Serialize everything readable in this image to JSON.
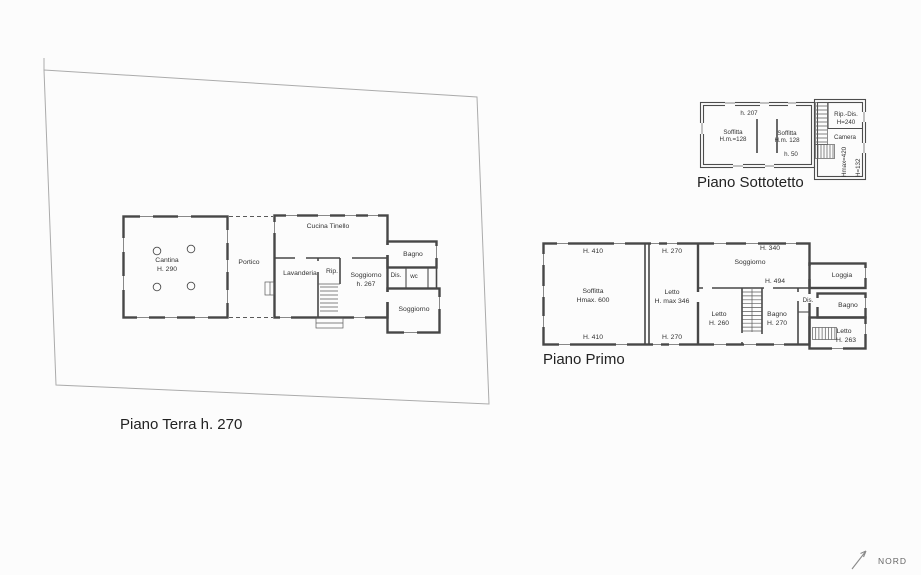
{
  "colors": {
    "background": "#fcfcfc",
    "walls": "#474747",
    "site_boundary": "#ababab",
    "text": "#333333"
  },
  "piano_terra": {
    "title": "Piano Terra h. 270",
    "labels": {
      "cantina": "Cantina",
      "cantina_height": "H. 290",
      "portico": "Portico",
      "cucina_tinello": "Cucina Tinello",
      "lavanderia": "Lavanderia",
      "rip": "Rip.",
      "soggiorno": "Soggiorno",
      "soggiorno_height": "h. 267",
      "dis": "Dis.",
      "wc": "wc",
      "bagno": "Bagno",
      "soggiorno_2": "Soggiorno"
    }
  },
  "piano_primo": {
    "title": "Piano Primo",
    "labels": {
      "h410_top": "H. 410",
      "h410_bottom": "H. 410",
      "soffitta": "Soffitta",
      "soffitta_height": "Hmax. 600",
      "h270_top": "H. 270",
      "h270_bottom": "H. 270",
      "letto_1": "Letto",
      "letto_1_height": "H. max 346",
      "soggiorno": "Soggiorno",
      "h340": "H. 340",
      "h494": "H. 494",
      "letto_2": "Letto",
      "letto_2_height": "H. 260",
      "bagno_1": "Bagno",
      "bagno_1_height": "H. 270",
      "dis": "Dis.",
      "loggia": "Loggia",
      "bagno_2": "Bagno",
      "letto_3": "Letto",
      "letto_3_height": "H. 263"
    }
  },
  "piano_sottotetto": {
    "title": "Piano Sottotetto",
    "labels": {
      "h207": "h. 207",
      "soffitta_1": "Soffitta",
      "soffitta_1_height": "H.m.=128",
      "soffitta_2": "Soffitta",
      "soffitta_2_height": "H.m. 128",
      "h50": "h. 50",
      "rip_dis": "Rip.-Dis.",
      "rip_dis_height": "H=240",
      "camera": "Camera",
      "hmax420": "Hmax=420",
      "h132": "H=132"
    }
  },
  "compass": {
    "label": "NORD"
  }
}
